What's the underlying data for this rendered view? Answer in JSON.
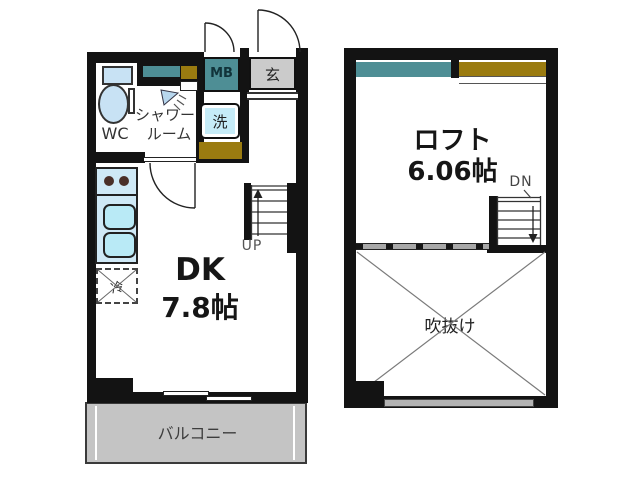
{
  "plan_type": "apartment-floorplan",
  "first_floor": {
    "wc": "WC",
    "shower_line1": "シャワー",
    "shower_line2": "ルーム",
    "meter_box": "MB",
    "entrance": "玄",
    "laundry": "洗",
    "fridge": "冷",
    "stairs_up": "UP",
    "room_name": "DK",
    "room_size": "7.8帖",
    "balcony": "バルコニー"
  },
  "loft_floor": {
    "room_name": "ロフト",
    "room_size": "6.06帖",
    "stairs_down": "DN",
    "void": "吹抜け"
  },
  "colors": {
    "wall": "#131313",
    "meter_box_teal": "#4e8e95",
    "storage_olive": "#9a7b10",
    "entrance_gray": "#cbcbcb",
    "balcony_gray": "#c4c4c4",
    "laundry_blue": "#c6ecf8",
    "counter_blue": "#cfe9f6",
    "sink_blue": "#b9eaf6",
    "toilet_blue": "#c8e2f4"
  }
}
